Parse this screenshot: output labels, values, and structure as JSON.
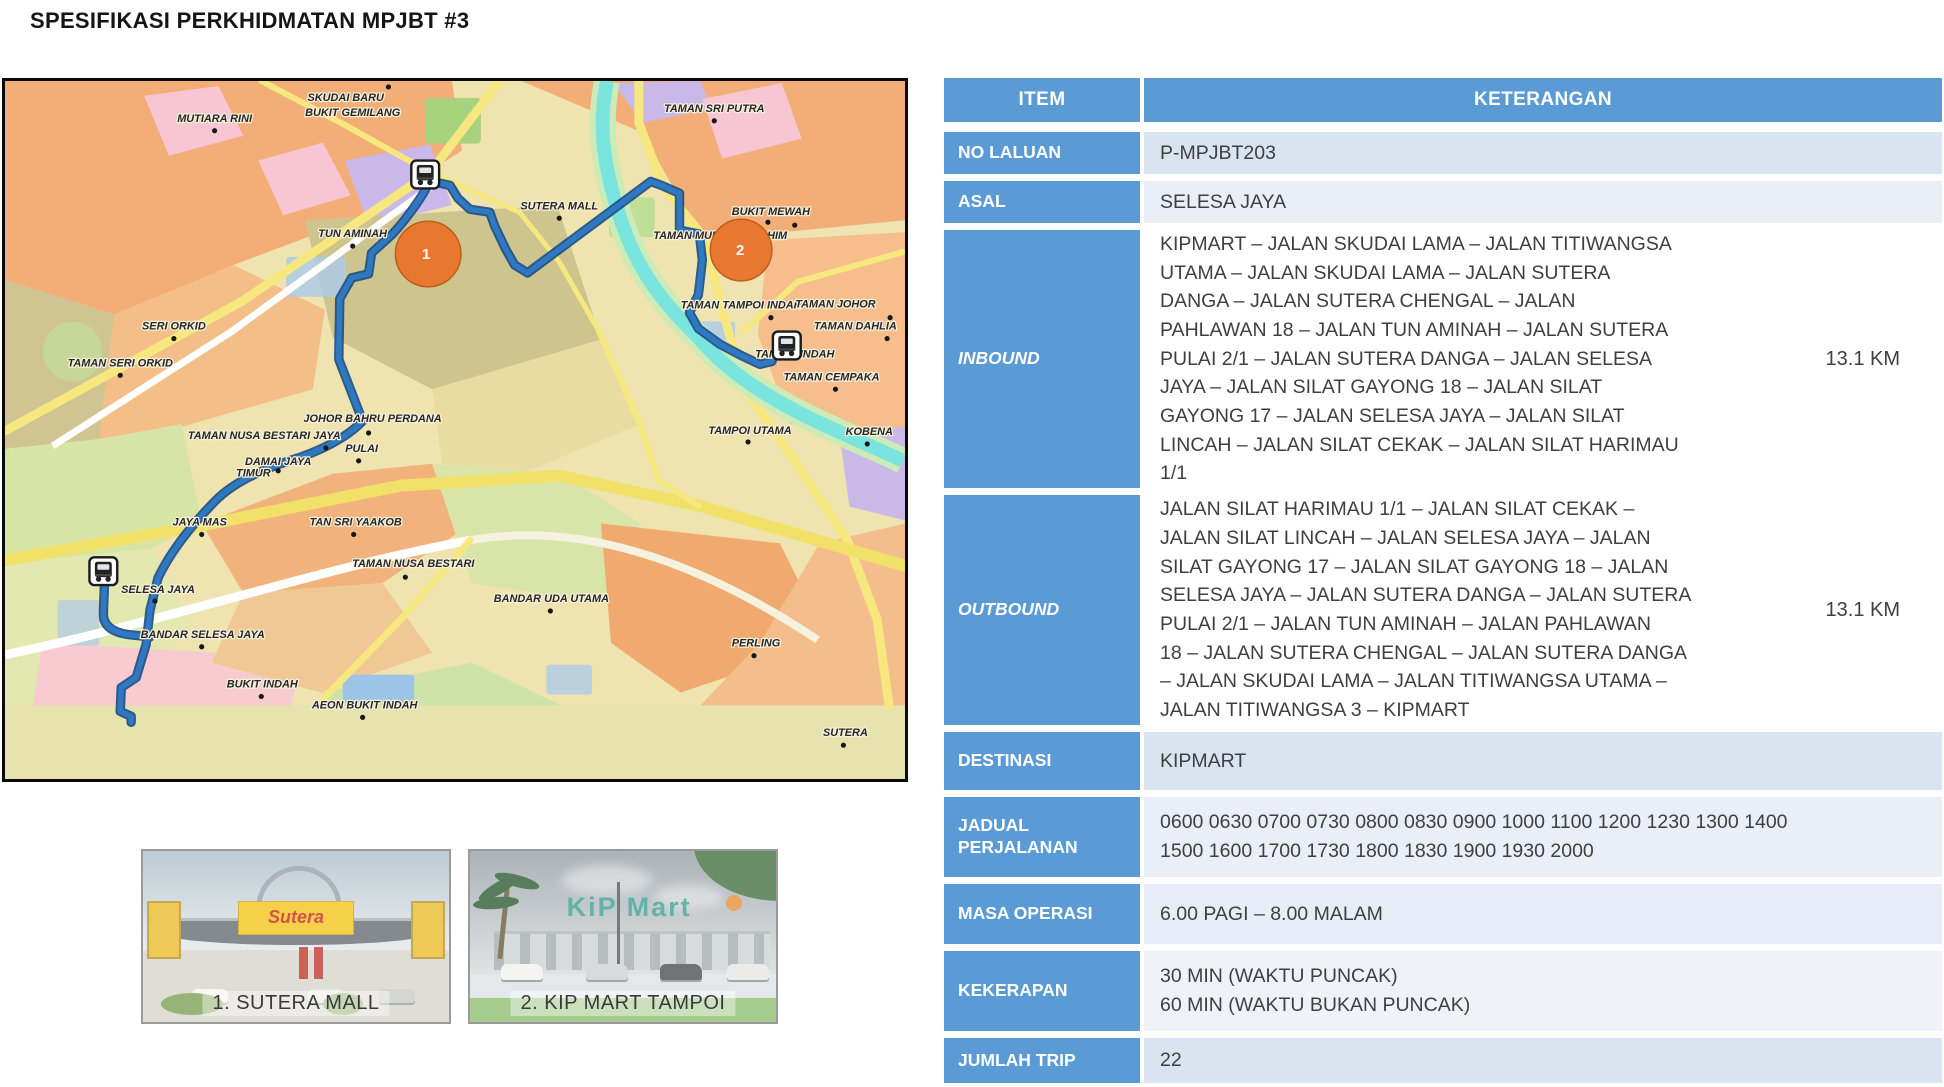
{
  "header": {
    "title": "SPESIFIKASI PERKHIDMATAN MPJBT #3"
  },
  "colors": {
    "table_accent": "#5B9BD5",
    "band_dark": "#DAE3F0",
    "band_light": "#E9EEF7",
    "route_line": "#2F78C2",
    "stop_marker": "#E8782F",
    "river": "#7AE4DF"
  },
  "map": {
    "stops": [
      {
        "number": "1"
      },
      {
        "number": "2"
      }
    ],
    "labels": [
      "SKUDAI BARU",
      "BUKIT GEMILANG",
      "MUTIARA RINI",
      "TAMAN SRI PUTRA",
      "SUTERA MALL",
      "TUN AMINAH",
      "BUKIT MEWAH",
      "TAMAN MUNSYI IBRAHIM",
      "TAMAN TAMPOI INDAH",
      "TAMAN JOHOR",
      "TAMAN DAHLIA",
      "TAMPOI INDAH",
      "TAMAN CEMPAKA",
      "TAMPOI UTAMA",
      "KOBENA",
      "SERI ORKID",
      "TAMAN SERI ORKID",
      "JOHOR BAHRU PERDANA",
      "TAMAN NUSA BESTARI JAYA",
      "PULAI",
      "DAMAI JAYA",
      "TIMUR",
      "JAYA MAS",
      "TAN SRI YAAKOB",
      "TAMAN NUSA BESTARI",
      "SELESA JAYA",
      "BANDAR SELESA JAYA",
      "BUKIT INDAH",
      "AEON BUKIT INDAH",
      "BANDAR UDA UTAMA",
      "PERLING",
      "SUTERA"
    ]
  },
  "photos": [
    {
      "caption": "1. SUTERA MALL",
      "sign_text": "Sutera"
    },
    {
      "caption": "2. KIP MART TAMPOI",
      "sign_text": "KiP Mart"
    }
  ],
  "table": {
    "columns": [
      "ITEM",
      "KETERANGAN"
    ],
    "rows": [
      {
        "label": "NO LALUAN",
        "value": "P-MPJBT203"
      },
      {
        "label": "ASAL",
        "value": "SELESA JAYA"
      },
      {
        "label": "INBOUND",
        "value": "KIPMART – JALAN SKUDAI LAMA – JALAN TITIWANGSA\nUTAMA – JALAN SKUDAI LAMA – JALAN SUTERA\nDANGA – JALAN SUTERA CHENGAL – JALAN\nPAHLAWAN 18 – JALAN TUN AMINAH – JALAN SUTERA\nPULAI 2/1 – JALAN SUTERA DANGA – JALAN SELESA\nJAYA – JALAN SILAT GAYONG 18 – JALAN SILAT\nGAYONG 17 – JALAN SELESA JAYA – JALAN SILAT\nLINCAH – JALAN SILAT CEKAK – JALAN SILAT HARIMAU\n1/1",
        "distance": "13.1 KM"
      },
      {
        "label": "OUTBOUND",
        "value": "JALAN SILAT HARIMAU 1/1 – JALAN SILAT CEKAK –\nJALAN SILAT LINCAH – JALAN SELESA JAYA – JALAN\nSILAT GAYONG 17 – JALAN SILAT GAYONG 18 – JALAN\nSELESA JAYA – JALAN SUTERA DANGA – JALAN SUTERA\nPULAI 2/1 – JALAN TUN AMINAH – JALAN PAHLAWAN\n18 – JALAN SUTERA CHENGAL – JALAN SUTERA DANGA\n– JALAN SKUDAI LAMA – JALAN TITIWANGSA UTAMA –\nJALAN TITIWANGSA 3 – KIPMART",
        "distance": "13.1 KM"
      },
      {
        "label": "DESTINASI",
        "value": "KIPMART"
      },
      {
        "label": "JADUAL PERJALANAN",
        "value": "0600 0630 0700 0730 0800 0830 0900 1000 1100 1200 1230 1300 1400\n1500 1600 1700 1730 1800 1830 1900 1930 2000"
      },
      {
        "label": "MASA OPERASI",
        "value": "6.00 PAGI – 8.00 MALAM"
      },
      {
        "label": "KEKERAPAN",
        "value": "30 MIN (WAKTU PUNCAK)\n60 MIN (WAKTU BUKAN PUNCAK)"
      },
      {
        "label": "JUMLAH TRIP",
        "value": "22"
      }
    ]
  }
}
